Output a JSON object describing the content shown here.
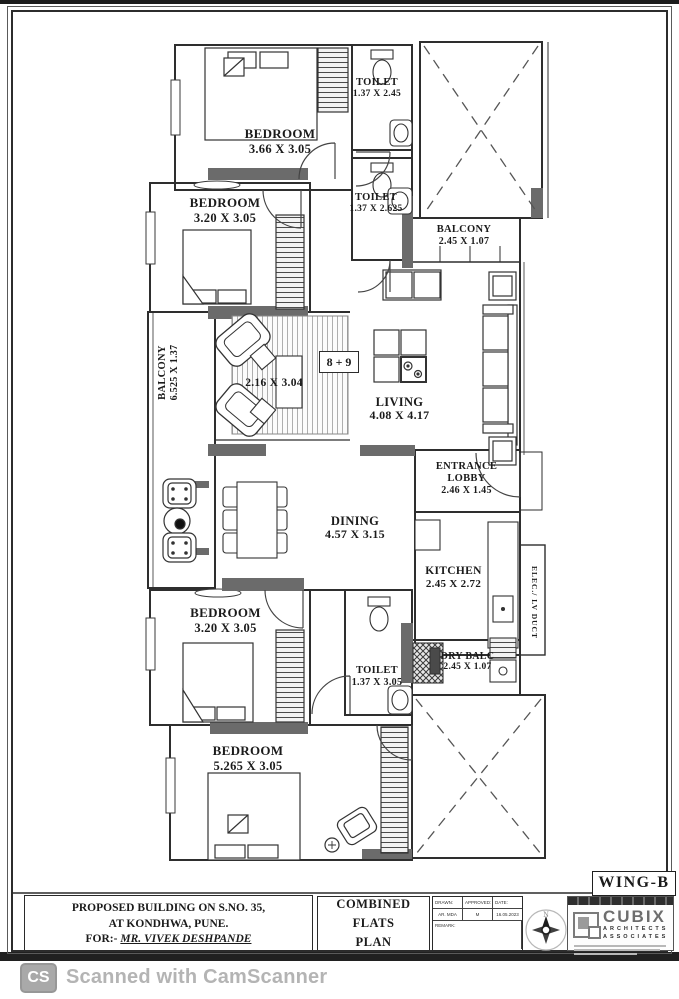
{
  "plan": {
    "unit_label": "8 + 9",
    "rooms": {
      "bedroom_top": {
        "name": "BEDROOM",
        "dims": "3.66 X 3.05"
      },
      "toilet_top": {
        "name": "TOILET",
        "dims": "1.37 X 2.45"
      },
      "bedroom_mid": {
        "name": "BEDROOM",
        "dims": "3.20 X 3.05"
      },
      "toilet_mid": {
        "name": "TOILET",
        "dims": "1.37 X 2.625"
      },
      "balcony_top_right": {
        "name": "BALCONY",
        "dims": "2.45 X 1.07"
      },
      "balcony_left": {
        "name": "BALCONY",
        "dims": "6.525 X 1.37"
      },
      "sitting_area": {
        "dims": "2.16 X 3.04"
      },
      "living": {
        "name": "LIVING",
        "dims": "4.08 X 4.17"
      },
      "entrance_lobby": {
        "name_line1": "ENTRANCE",
        "name_line2": "LOBBY",
        "dims": "2.46 X 1.45"
      },
      "dining": {
        "name": "DINING",
        "dims": "4.57 X 3.15"
      },
      "kitchen": {
        "name": "KITCHEN",
        "dims": "2.45 X 2.72"
      },
      "toilet_bottom": {
        "name": "TOILET",
        "dims": "1.37 X 3.05"
      },
      "dry_balcony": {
        "name": "DRY BALC",
        "dims": "2.45 X 1.07"
      },
      "elec_duct": {
        "name": "ELEC./ LV DUCT"
      },
      "bedroom_bottom_left": {
        "name": "BEDROOM",
        "dims": "3.20 X 3.05"
      },
      "bedroom_bottom": {
        "name": "BEDROOM",
        "dims": "5.265 X 3.05"
      }
    }
  },
  "title_block": {
    "wing_label": "WING-B",
    "project_line1": "PROPOSED BUILDING ON S.NO. 35,",
    "project_line2": "AT KONDHWA, PUNE.",
    "for_prefix": "FOR:- ",
    "client_name": "MR. VIVEK DESHPANDE",
    "drawing_title_line1": "COMBINED FLATS",
    "drawing_title_line2": "PLAN",
    "info_table": {
      "col1_header": "DRAWN:",
      "col2_header": "APPROVED:",
      "col3_header": "DATE:",
      "col1_value": "AR. MDA",
      "col2_value": "M",
      "col3_value": "16.05.2023",
      "remark_label": "REMARK:"
    },
    "compass_north_label": "N",
    "architect_logo": {
      "name": "CUBIX",
      "sub_line1": "ARCHITECTS",
      "sub_line2": "ASSOCIATES"
    }
  },
  "scanner_footer": {
    "badge_text": "CS",
    "label": "Scanned with CamScanner"
  }
}
